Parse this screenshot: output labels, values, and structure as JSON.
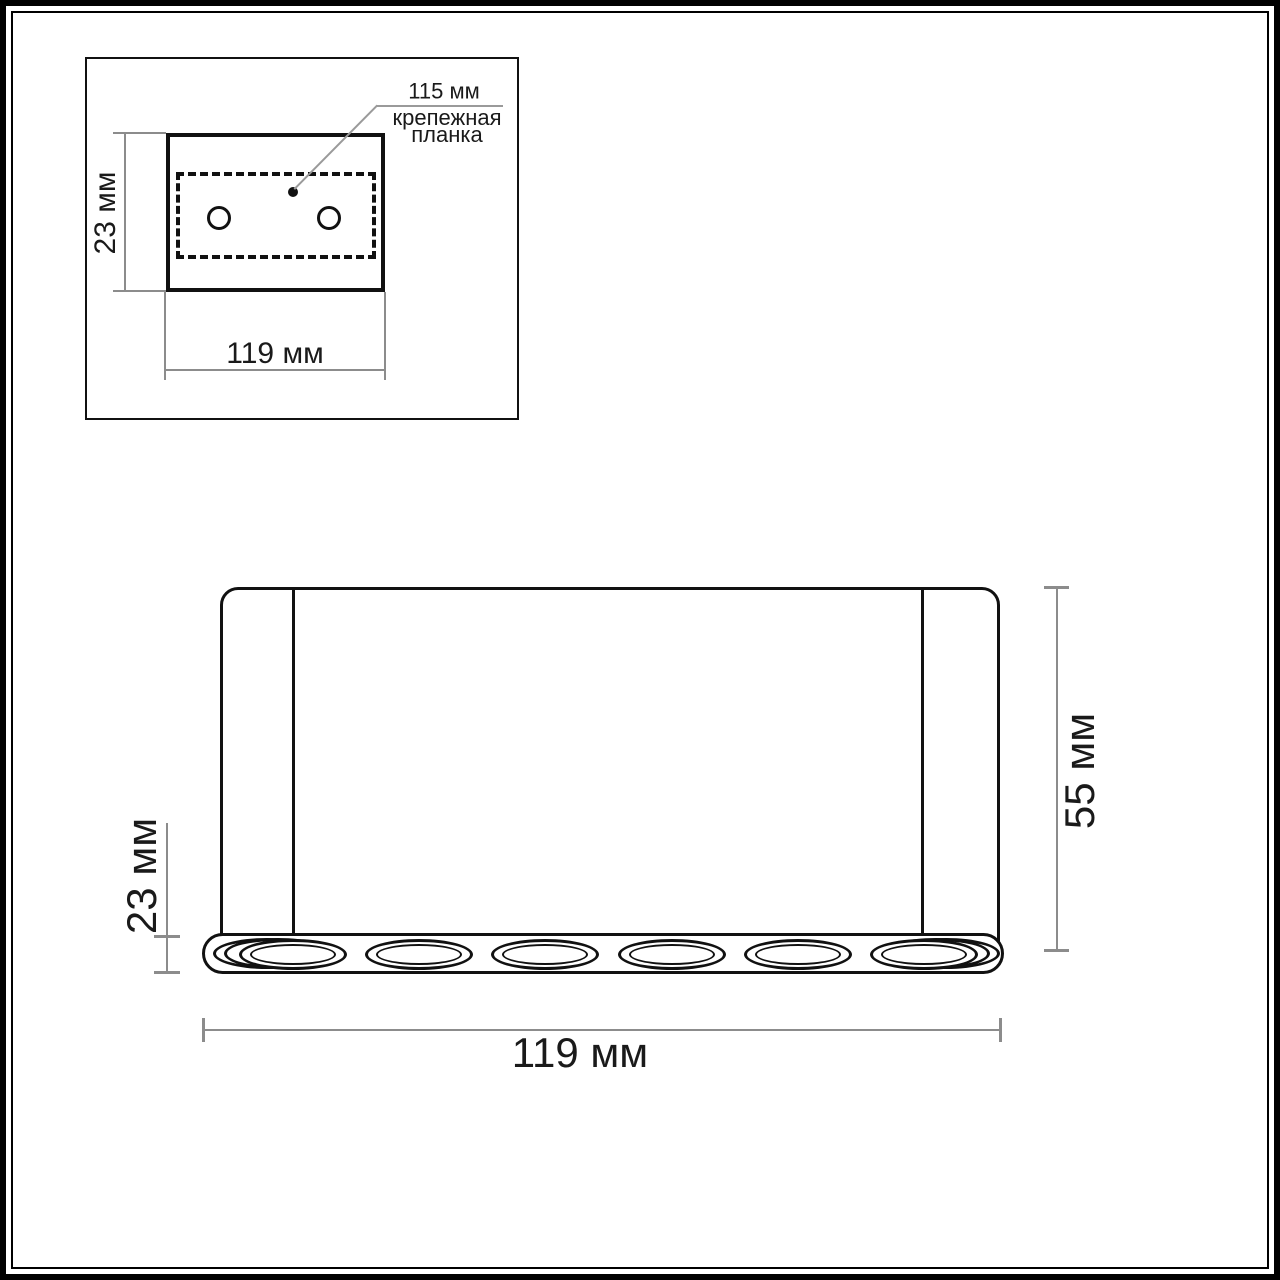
{
  "inset": {
    "plate_width_label": "115 мм",
    "plate_caption": [
      "крепежная",
      "планка"
    ],
    "height_label": "23 мм",
    "width_label": "119 мм"
  },
  "front": {
    "height_label": "55 мм",
    "base_height_label": "23 мм",
    "width_label": "119 мм",
    "spot_count": 6
  },
  "colors": {
    "drawing_line": "#111111",
    "dimension_line": "#8c8c8c",
    "text": "#1a1a1a",
    "background": "#ffffff"
  }
}
